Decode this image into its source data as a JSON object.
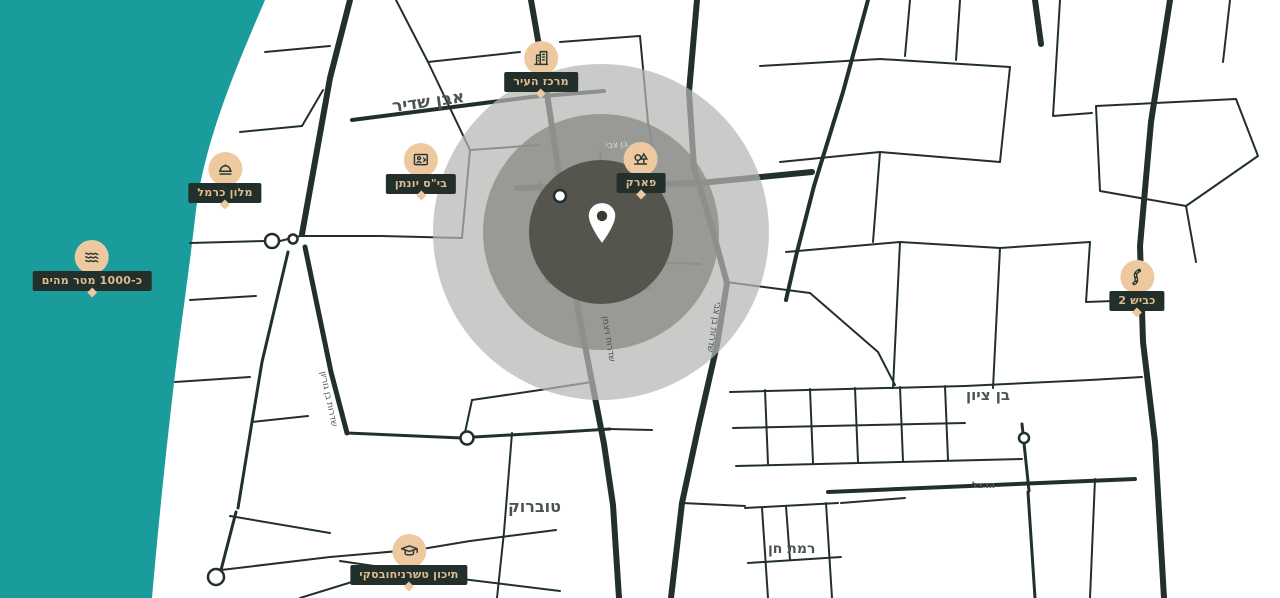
{
  "colors": {
    "sea": "#1a9b9c",
    "road": "#22302c",
    "label-bg": "#222f2a",
    "label-text": "#dcbd92",
    "marker-bg": "#eec9a0",
    "icon-stroke": "#2a3a34",
    "radius-outer": "#b6b7b3",
    "radius-mid": "#8e8f8a",
    "radius-inner": "#4e4e45",
    "street-text": "#4b5450",
    "street-text-light": "#d8dcd9",
    "pin-fill": "#ffffff",
    "pin-hole": "#3a3a33"
  },
  "pois": [
    {
      "label": "מרכז העיר",
      "icon": "city-hall-icon"
    },
    {
      "label": "מלון כרמל",
      "icon": "hotel-icon"
    },
    {
      "label": "בי\"ס יונתן",
      "icon": "school-icon"
    },
    {
      "label": "פארק",
      "icon": "park-icon"
    },
    {
      "label": "כ-1000 מטר מהים",
      "icon": "waves-icon"
    },
    {
      "label": "כביש 2",
      "icon": "highway-icon"
    },
    {
      "label": "תיכון טשרניחובסקי",
      "icon": "graduation-cap-icon"
    }
  ],
  "streets": [
    {
      "label": "אבן שדיר"
    },
    {
      "label": "בן צבי"
    },
    {
      "label": "בן ציון"
    },
    {
      "label": "טוברוק"
    },
    {
      "label": "רמת חן"
    },
    {
      "label": "הרצל"
    },
    {
      "label": "שדרות בן גוריון"
    },
    {
      "label": "שדרות ויצמן"
    },
    {
      "label": "שדרות בן צבי"
    }
  ]
}
